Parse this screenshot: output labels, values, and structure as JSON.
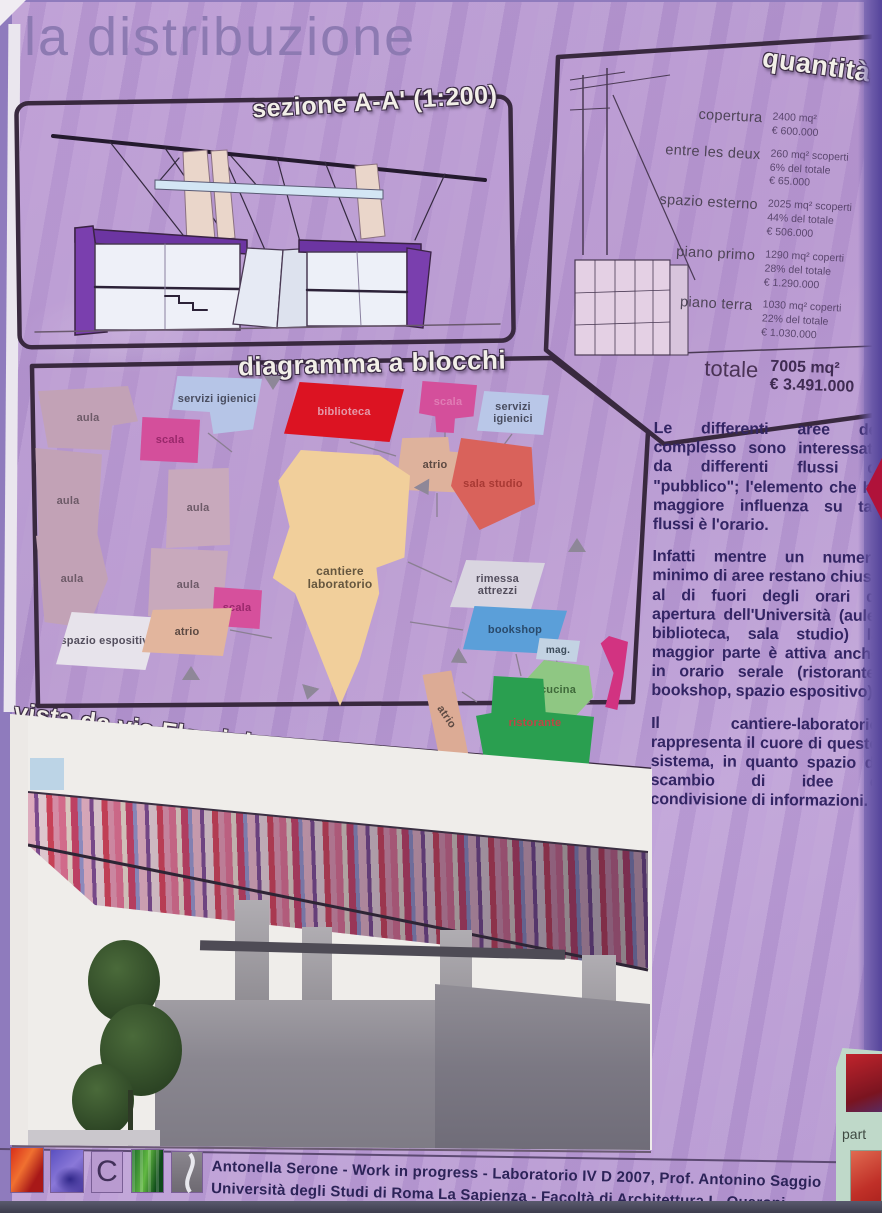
{
  "title": "la distribuzione",
  "section": {
    "label": "sezione A-A' (1:200)"
  },
  "quantita": {
    "label": "quantità",
    "rows": [
      {
        "name": "copertura",
        "l1": "2400 mq²",
        "l2": "€ 600.000",
        "l3": ""
      },
      {
        "name": "entre les deux",
        "l1": "260 mq² scoperti",
        "l2": "6% del totale",
        "l3": "€ 65.000"
      },
      {
        "name": "spazio esterno",
        "l1": "2025 mq² scoperti",
        "l2": "44% del totale",
        "l3": "€ 506.000"
      },
      {
        "name": "piano primo",
        "l1": "1290 mq² coperti",
        "l2": "28% del totale",
        "l3": "€ 1.290.000"
      },
      {
        "name": "piano terra",
        "l1": "1030 mq² coperti",
        "l2": "22% del totale",
        "l3": "€ 1.030.000"
      }
    ],
    "totale": {
      "name": "totale",
      "l1": "7005 mq²",
      "l2": "€ 3.491.000"
    }
  },
  "diagram": {
    "label": "diagramma a blocchi",
    "blocks": [
      {
        "label": "aula",
        "color": "#c2a2b6",
        "text_color": "#6d5a68"
      },
      {
        "label": "scala",
        "color": "#d44f9b",
        "text_color": "#99286b"
      },
      {
        "label": "servizi igienici",
        "color": "#b6c5e7",
        "text_color": "#494d60"
      },
      {
        "label": "biblioteca",
        "color": "#dc1322",
        "text_color": "#e598a8"
      },
      {
        "label": "scala",
        "color": "#d44f9b",
        "text_color": "#e07db5"
      },
      {
        "label": "servizi igienici",
        "color": "#b9c7e8",
        "text_color": "#494d60"
      },
      {
        "label": "atrio",
        "color": "#deb29c",
        "text_color": "#5d4a43"
      },
      {
        "label": "sala studio",
        "color": "#d9625b",
        "text_color": "#a83934"
      },
      {
        "label": "aula",
        "color": "#c2a2b6",
        "text_color": "#6d5a68"
      },
      {
        "label": "aula",
        "color": "#c8a9bc",
        "text_color": "#6d5a68"
      },
      {
        "label": "aula",
        "color": "#c8a9bc",
        "text_color": "#6d5a68"
      },
      {
        "label": "aula",
        "color": "#c2a2b6",
        "text_color": "#6d5a68"
      },
      {
        "label": "scala",
        "color": "#d6509c",
        "text_color": "#99286b"
      },
      {
        "label": "spazio espositivo",
        "color": "#e7e3eb",
        "text_color": "#534e5d"
      },
      {
        "label": "atrio",
        "color": "#e2b59d",
        "text_color": "#5d4a43"
      },
      {
        "label": "cantiere laboratorio",
        "color": "#f1cf9b",
        "text_color": "#66573f"
      },
      {
        "label": "rimessa attrezzi",
        "color": "#d9d5e0",
        "text_color": "#534e5d"
      },
      {
        "label": "bookshop",
        "color": "#5b9fd9",
        "text_color": "#2a4a6b"
      },
      {
        "label": "mag.",
        "color": "#c3d3e3",
        "text_color": "#3c4c5a"
      },
      {
        "label": "cucina",
        "color": "#8fc783",
        "text_color": "#3f6a3a"
      },
      {
        "label": "ristorante",
        "color": "#2a9f50",
        "text_color": "#bf4545"
      },
      {
        "label": "atrio",
        "color": "#dcab95",
        "text_color": "#5d4a43"
      },
      {
        "label": "",
        "color": "#d23381",
        "text_color": "#d23381"
      }
    ]
  },
  "paragraphs": [
    "Le differenti aree del complesso sono interessate da differenti flussi di \"pubblico\"; l'elemento che ha maggiore influenza su tali flussi è l'orario.",
    "Infatti mentre un numero minimo di aree restano chiuse al di fuori degli orari di apertura dell'Università (aule, biblioteca, sala studio) la maggior parte è attiva anche in orario serale (ristorante, bookshop, spazio espositivo).",
    "Il cantiere-laboratorio rappresenta il cuore di questo sistema, in quanto spazio di scambio di idee e condivisione di informazioni."
  ],
  "vista": {
    "label": "vista da via Flaminia"
  },
  "credits": {
    "line1": "Antonella Serone - Work in progress - Laboratorio IV D 2007, Prof. Antonino Saggio",
    "line2": "Università degli Studi di Roma La Sapienza - Facoltà di Architettura L. Quaroni"
  },
  "logos": {
    "c_label": "C"
  },
  "neighbor": {
    "partial_text": "part"
  }
}
